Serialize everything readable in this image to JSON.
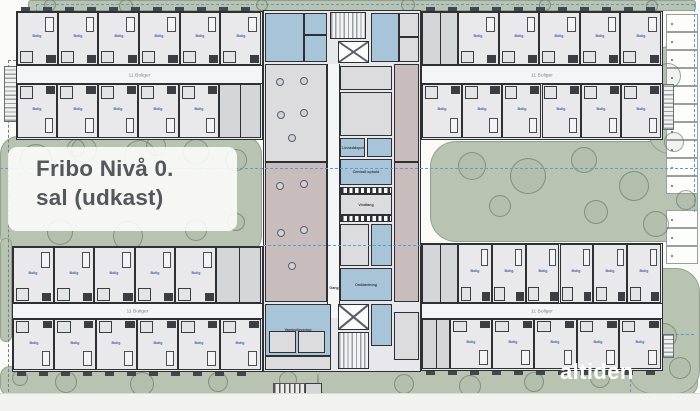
{
  "slide": {
    "title_line1": "Fribo Nivå 0.",
    "title_line2": "sal (udkast)",
    "logo_text": "altiden"
  },
  "colors": {
    "green": "#b9c3b2",
    "floor": "#e9e9ec",
    "wall": "#2e3033",
    "hall": "#f4f5f7",
    "blue_room": "#a8c4d8",
    "mauve_room": "#c9bcbc",
    "boundary_blue": "#5d9bd3",
    "title_text": "#54585c"
  },
  "plan": {
    "corridor_label": "11 Boliger",
    "unit_label": "Bolig",
    "gang_label": "Gang",
    "wings": [
      {
        "id": "top-left",
        "x": 16,
        "y": 11,
        "w": 247,
        "h": 129,
        "corridor_y": 53,
        "corridor_h": 19,
        "outer": "top",
        "rows": [
          {
            "pos": "top",
            "units": 6
          },
          {
            "pos": "bottom",
            "units": 5,
            "utility": {
              "side": "right",
              "w": 42
            }
          }
        ]
      },
      {
        "id": "top-right",
        "x": 421,
        "y": 11,
        "w": 242,
        "h": 129,
        "corridor_y": 53,
        "corridor_h": 19,
        "outer": "top",
        "rows": [
          {
            "pos": "top",
            "units": 5,
            "utility": {
              "side": "left",
              "w": 36
            }
          },
          {
            "pos": "bottom",
            "units": 6
          }
        ]
      },
      {
        "id": "bottom-left",
        "x": 12,
        "y": 246,
        "w": 251,
        "h": 126,
        "corridor_y": 56,
        "corridor_h": 16,
        "outer": "bottom",
        "rows": [
          {
            "pos": "top",
            "units": 5,
            "utility": {
              "side": "right",
              "w": 45
            }
          },
          {
            "pos": "bottom",
            "units": 6
          }
        ]
      },
      {
        "id": "bottom-right",
        "x": 421,
        "y": 243,
        "w": 242,
        "h": 128,
        "corridor_y": 59,
        "corridor_h": 16,
        "outer": "bottom",
        "rows": [
          {
            "pos": "top",
            "units": 6,
            "utility": {
              "side": "left",
              "w": 36
            }
          },
          {
            "pos": "bottom",
            "units": 5,
            "utility": {
              "side": "left",
              "w": 28
            }
          }
        ]
      }
    ],
    "core": {
      "x": 263,
      "y": 10,
      "w": 158,
      "h": 362
    },
    "hall": {
      "x": 327,
      "y": 64,
      "w": 13,
      "h": 254
    },
    "core_rooms": [
      {
        "x": 265,
        "y": 13,
        "w": 39,
        "h": 49,
        "t": "blue",
        "n": "office"
      },
      {
        "x": 304,
        "y": 13,
        "w": 23,
        "h": 22,
        "t": "blue",
        "n": "office-small"
      },
      {
        "x": 304,
        "y": 35,
        "w": 23,
        "h": 27,
        "t": "blue",
        "n": "wc"
      },
      {
        "x": 330,
        "y": 12,
        "w": 36,
        "h": 27,
        "t": "stair",
        "n": "stair-top"
      },
      {
        "x": 338,
        "y": 41,
        "w": 31,
        "h": 22,
        "t": "elevator",
        "n": "elevator-top"
      },
      {
        "x": 371,
        "y": 13,
        "w": 28,
        "h": 49,
        "t": "blue",
        "n": "office"
      },
      {
        "x": 399,
        "y": 13,
        "w": 20,
        "h": 24,
        "t": "gray",
        "n": "storage"
      },
      {
        "x": 399,
        "y": 37,
        "w": 20,
        "h": 25,
        "t": "gray",
        "n": "storage"
      },
      {
        "x": 265,
        "y": 64,
        "w": 62,
        "h": 98,
        "t": "gray",
        "n": "common-room",
        "furn": "tables"
      },
      {
        "x": 340,
        "y": 66,
        "w": 52,
        "h": 24,
        "t": "gray",
        "n": "anteroom"
      },
      {
        "x": 340,
        "y": 92,
        "w": 52,
        "h": 44,
        "t": "gray",
        "n": "depot"
      },
      {
        "x": 394,
        "y": 64,
        "w": 25,
        "h": 98,
        "t": "mauve",
        "n": "work-area"
      },
      {
        "x": 340,
        "y": 138,
        "w": 25,
        "h": 19,
        "t": "blue",
        "label": "Linneddepot",
        "n": "linneddepot"
      },
      {
        "x": 367,
        "y": 138,
        "w": 25,
        "h": 19,
        "t": "blue",
        "n": "depot-small"
      },
      {
        "x": 340,
        "y": 159,
        "w": 52,
        "h": 26,
        "t": "blue",
        "label": "Centralt ophold",
        "n": "centralt-ophold"
      },
      {
        "x": 340,
        "y": 187,
        "w": 52,
        "h": 7,
        "t": "checker",
        "n": "glass-front"
      },
      {
        "x": 340,
        "y": 194,
        "w": 52,
        "h": 21,
        "t": "gray",
        "label": "Vindfang",
        "n": "vindfang"
      },
      {
        "x": 340,
        "y": 215,
        "w": 52,
        "h": 7,
        "t": "checker",
        "n": "glass-front"
      },
      {
        "x": 265,
        "y": 162,
        "w": 62,
        "h": 140,
        "t": "mauve",
        "n": "faellesareal",
        "furn": "tables"
      },
      {
        "x": 394,
        "y": 162,
        "w": 25,
        "h": 140,
        "t": "mauve",
        "n": "work-area"
      },
      {
        "x": 340,
        "y": 224,
        "w": 29,
        "h": 42,
        "t": "gray",
        "n": "personale"
      },
      {
        "x": 371,
        "y": 224,
        "w": 21,
        "h": 42,
        "t": "blue",
        "n": "wc"
      },
      {
        "x": 340,
        "y": 268,
        "w": 52,
        "h": 33,
        "t": "blue",
        "label": "Omklædning",
        "n": "omklaedning"
      },
      {
        "x": 265,
        "y": 304,
        "w": 66,
        "h": 52,
        "t": "blue",
        "label": "Vareindlevering",
        "n": "vareindlevering"
      },
      {
        "x": 269,
        "y": 331,
        "w": 27,
        "h": 22,
        "t": "gray",
        "n": "storage"
      },
      {
        "x": 298,
        "y": 331,
        "w": 27,
        "h": 22,
        "t": "gray",
        "n": "storage"
      },
      {
        "x": 338,
        "y": 304,
        "w": 31,
        "h": 26,
        "t": "elevator",
        "n": "elevator-bottom"
      },
      {
        "x": 338,
        "y": 332,
        "w": 31,
        "h": 37,
        "t": "stair",
        "n": "stair-bottom"
      },
      {
        "x": 371,
        "y": 304,
        "w": 21,
        "h": 42,
        "t": "blue",
        "n": "wc"
      },
      {
        "x": 394,
        "y": 312,
        "w": 25,
        "h": 48,
        "t": "gray",
        "n": "storage"
      },
      {
        "x": 265,
        "y": 356,
        "w": 66,
        "h": 14,
        "t": "gray",
        "n": "storage"
      },
      {
        "x": 273,
        "y": 383,
        "w": 32,
        "h": 13,
        "t": "bike",
        "n": "bike-rack"
      },
      {
        "x": 305,
        "y": 383,
        "w": 17,
        "h": 14,
        "t": "shed",
        "n": "shed"
      }
    ],
    "ext_stairs": [
      {
        "x": 4,
        "y": 66,
        "w": 14,
        "h": 56
      },
      {
        "x": 663,
        "y": 84,
        "w": 11,
        "h": 46
      },
      {
        "x": 663,
        "y": 334,
        "w": 11,
        "h": 24
      }
    ],
    "greens": [
      {
        "x": 28,
        "y": 0,
        "w": 668,
        "h": 11,
        "r": 3
      },
      {
        "x": 0,
        "y": 136,
        "w": 262,
        "h": 118,
        "r": 18
      },
      {
        "x": 430,
        "y": 141,
        "w": 268,
        "h": 101,
        "r": 26
      },
      {
        "x": 648,
        "y": 46,
        "w": 50,
        "h": 108,
        "r": 22
      },
      {
        "x": 0,
        "y": 238,
        "w": 12,
        "h": 104,
        "r": 6
      },
      {
        "x": 0,
        "y": 366,
        "w": 318,
        "h": 30,
        "r": 10
      },
      {
        "x": 318,
        "y": 364,
        "w": 380,
        "h": 32,
        "r": 12
      },
      {
        "x": 628,
        "y": 268,
        "w": 72,
        "h": 126,
        "r": 24
      }
    ],
    "trees": [
      [
        50,
        5,
        6
      ],
      [
        126,
        6,
        7
      ],
      [
        262,
        5,
        6
      ],
      [
        408,
        5,
        7
      ],
      [
        545,
        5,
        6
      ],
      [
        652,
        6,
        6
      ],
      [
        36,
        160,
        16
      ],
      [
        84,
        150,
        13
      ],
      [
        140,
        156,
        16
      ],
      [
        196,
        152,
        13
      ],
      [
        236,
        160,
        11
      ],
      [
        60,
        232,
        13
      ],
      [
        128,
        236,
        15
      ],
      [
        196,
        230,
        11
      ],
      [
        236,
        222,
        9
      ],
      [
        76,
        148,
        9
      ],
      [
        156,
        146,
        10
      ],
      [
        472,
        166,
        14
      ],
      [
        528,
        176,
        18
      ],
      [
        584,
        160,
        13
      ],
      [
        634,
        186,
        15
      ],
      [
        500,
        206,
        11
      ],
      [
        596,
        212,
        12
      ],
      [
        656,
        224,
        13
      ],
      [
        686,
        200,
        10
      ],
      [
        668,
        76,
        13
      ],
      [
        660,
        112,
        12
      ],
      [
        674,
        142,
        10
      ],
      [
        66,
        382,
        11
      ],
      [
        142,
        384,
        12
      ],
      [
        218,
        382,
        10
      ],
      [
        288,
        380,
        9
      ],
      [
        20,
        378,
        8
      ],
      [
        404,
        384,
        10
      ],
      [
        470,
        386,
        11
      ],
      [
        534,
        382,
        10
      ],
      [
        600,
        378,
        10
      ],
      [
        648,
        300,
        12
      ],
      [
        664,
        336,
        13
      ],
      [
        680,
        368,
        11
      ]
    ],
    "parking": [
      {
        "x": 666,
        "y": 14,
        "w": 32,
        "stall_h": 18,
        "count": 10
      },
      {
        "x": 666,
        "y": 210,
        "w": 32,
        "stall_h": 18,
        "count": 3
      }
    ],
    "boundaries": [
      {
        "x": 36,
        "y": 4,
        "len": 658,
        "dir": "h",
        "c": "blue"
      },
      {
        "x": 694,
        "y": 4,
        "len": 208,
        "dir": "v",
        "c": "blue"
      },
      {
        "x": 36,
        "y": 4,
        "len": 56,
        "dir": "v",
        "c": "blue"
      },
      {
        "x": 8,
        "y": 60,
        "len": 28,
        "dir": "h",
        "c": "gray"
      },
      {
        "x": 8,
        "y": 60,
        "len": 332,
        "dir": "v",
        "c": "gray"
      },
      {
        "x": 630,
        "y": 334,
        "len": 64,
        "dir": "h",
        "c": "blue"
      },
      {
        "x": 630,
        "y": 334,
        "len": 58,
        "dir": "v",
        "c": "blue"
      }
    ],
    "section_lines": [
      {
        "x": 0,
        "y": 168,
        "len": 698,
        "dir": "h"
      },
      {
        "x": 263,
        "y": 245,
        "len": 158,
        "dir": "h"
      }
    ]
  }
}
